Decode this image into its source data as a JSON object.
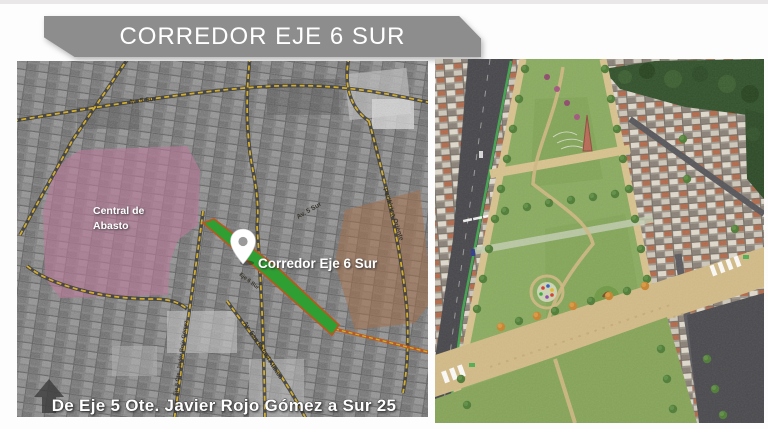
{
  "slide": {
    "title": "CORREDOR EJE 6 SUR",
    "banner_color": "#8d8d8d",
    "caption": "De Eje 5 Ote. Javier Rojo Gómez a Sur 25"
  },
  "map_panel": {
    "zone_labels": {
      "central_abasto_line1": "Central de",
      "central_abasto_line2": "Abasto",
      "corridor": "Corredor Eje 6 Sur"
    },
    "road_labels": {
      "av5sur": "Av. 5 Sur",
      "periferico": "Periférico Oriente",
      "san_rafael": "Av. San Rafael Atlixco",
      "eje5": "Eje 5 Ote. Javier Rojo Gómez",
      "eje6": "Eje 6 Sur"
    },
    "colors": {
      "pink_zone": "#bc7a9b",
      "brown_zone": "#a5714a",
      "corridor_green": "#2f9e33",
      "corridor_edge": "#bc571e",
      "road_dash_yellow": "#d3ad2c"
    }
  },
  "render_panel": {
    "colors": {
      "park_green": "#8aab5f",
      "plaza_tan": "#d3bb87",
      "road_gray": "#47474b",
      "forest_dark": "#31512a"
    }
  }
}
